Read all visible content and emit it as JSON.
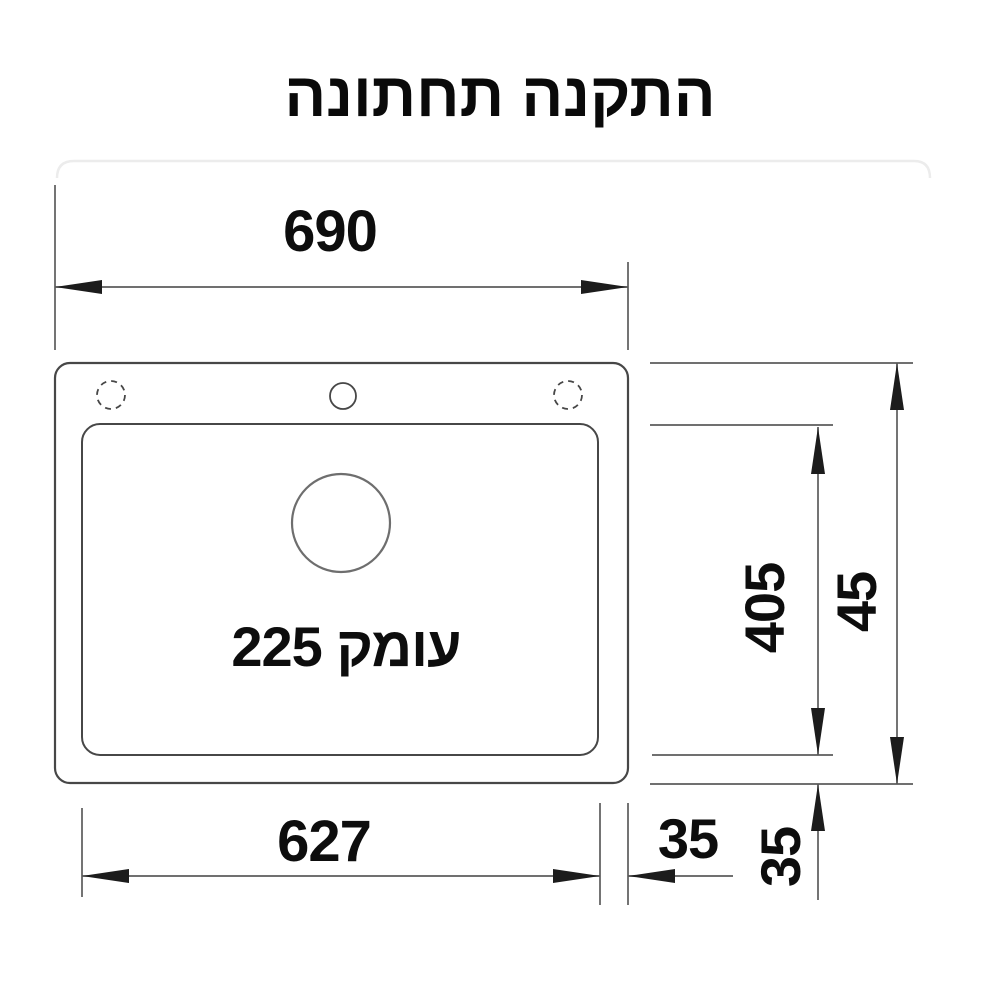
{
  "title": "התקנה תחתונה",
  "sink": {
    "depth_label": "עומק 225"
  },
  "dimensions": {
    "top_width": "690",
    "bottom_inner_width": "627",
    "bottom_edge_offset": "35",
    "right_inner_height": "405",
    "right_edge_offset": "35",
    "right_outer_height": "45"
  },
  "colors": {
    "background": "#ffffff",
    "outline": "#474747",
    "dimension_line": "#5c5c5c",
    "arrow": "#1c1c1c",
    "text": "#0d0d0d",
    "drain_circle": "#6e6e6e",
    "faint_divider": "#ececec"
  }
}
